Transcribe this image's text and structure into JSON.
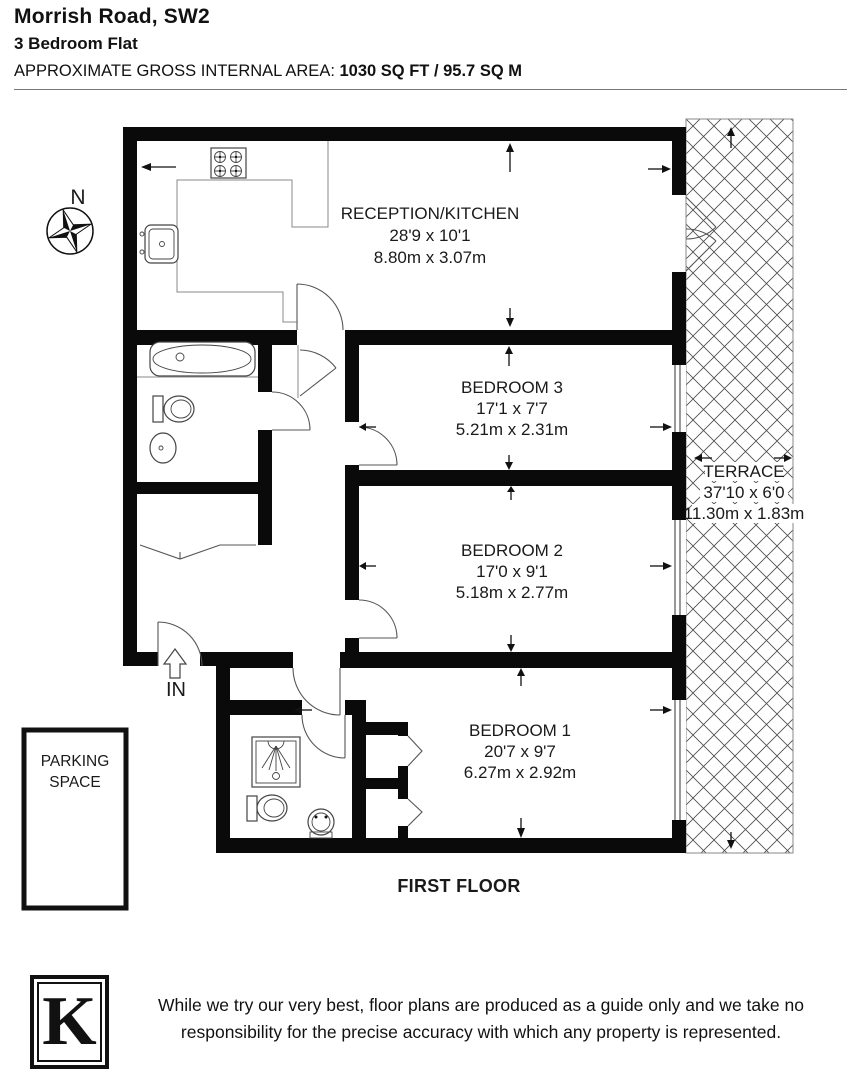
{
  "header": {
    "title": "Morrish Road, SW2",
    "subtitle": "3 Bedroom Flat",
    "area_label": "APPROXIMATE GROSS INTERNAL AREA: ",
    "area_value": "1030 SQ FT / 95.7 SQ M"
  },
  "compass": {
    "north_label": "N"
  },
  "entrance": {
    "label": "IN"
  },
  "floor_label": "FIRST FLOOR",
  "rooms": {
    "reception": {
      "name": "RECEPTION/KITCHEN",
      "imperial": "28'9 x 10'1",
      "metric": "8.80m x 3.07m"
    },
    "bedroom3": {
      "name": "BEDROOM 3",
      "imperial": "17'1 x 7'7",
      "metric": "5.21m x 2.31m"
    },
    "bedroom2": {
      "name": "BEDROOM 2",
      "imperial": "17'0 x 9'1",
      "metric": "5.18m x 2.77m"
    },
    "bedroom1": {
      "name": "BEDROOM 1",
      "imperial": "20'7 x 9'7",
      "metric": "6.27m x 2.92m"
    },
    "terrace": {
      "name": "TERRACE",
      "imperial": "37'10 x 6'0",
      "metric": "11.30m x 1.83m"
    },
    "parking": {
      "line1": "PARKING",
      "line2": "SPACE"
    }
  },
  "footer": {
    "logo_letter": "K",
    "disclaimer_line1": "While we try our very best, floor plans are produced as a guide only and we take no",
    "disclaimer_line2": "responsibility for the precise accuracy with which any property is represented."
  },
  "colors": {
    "wall": "#000000",
    "paper": "#ffffff",
    "line": "#555555"
  }
}
